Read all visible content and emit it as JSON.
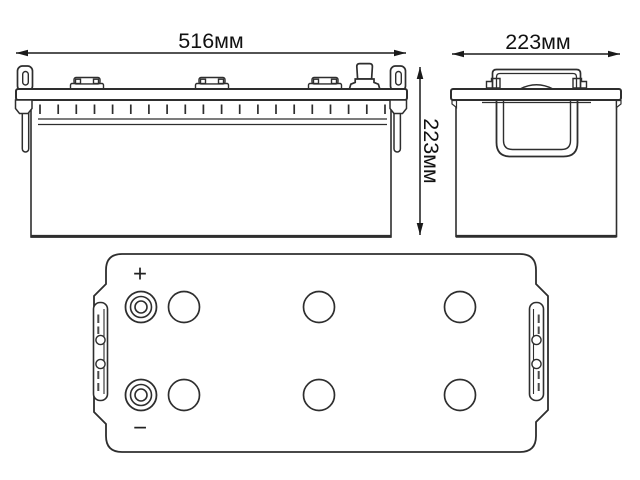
{
  "diagram": {
    "type": "battery-technical-drawing",
    "labels": {
      "front_width": "516мм",
      "front_height": "223мм",
      "side_width": "223мм",
      "plus": "+",
      "minus": "−"
    },
    "front_view": {
      "vent_cap_groups": 3,
      "terminal_posts": 1,
      "tick_marks": 20,
      "side_handles": 2
    },
    "side_view": {
      "carry_handle": "folded U-strap under lid",
      "lid_bracket": "raised handle bracket on top"
    },
    "top_view": {
      "vent_caps": 6,
      "vent_cap_rows": 2,
      "vent_cap_columns": 3,
      "terminals": 2,
      "handle_strips": 2
    },
    "colors": {
      "line": "#2e2e2e",
      "dimension_line": "#1a1a1a",
      "text": "#111111",
      "background": "#ffffff"
    }
  }
}
